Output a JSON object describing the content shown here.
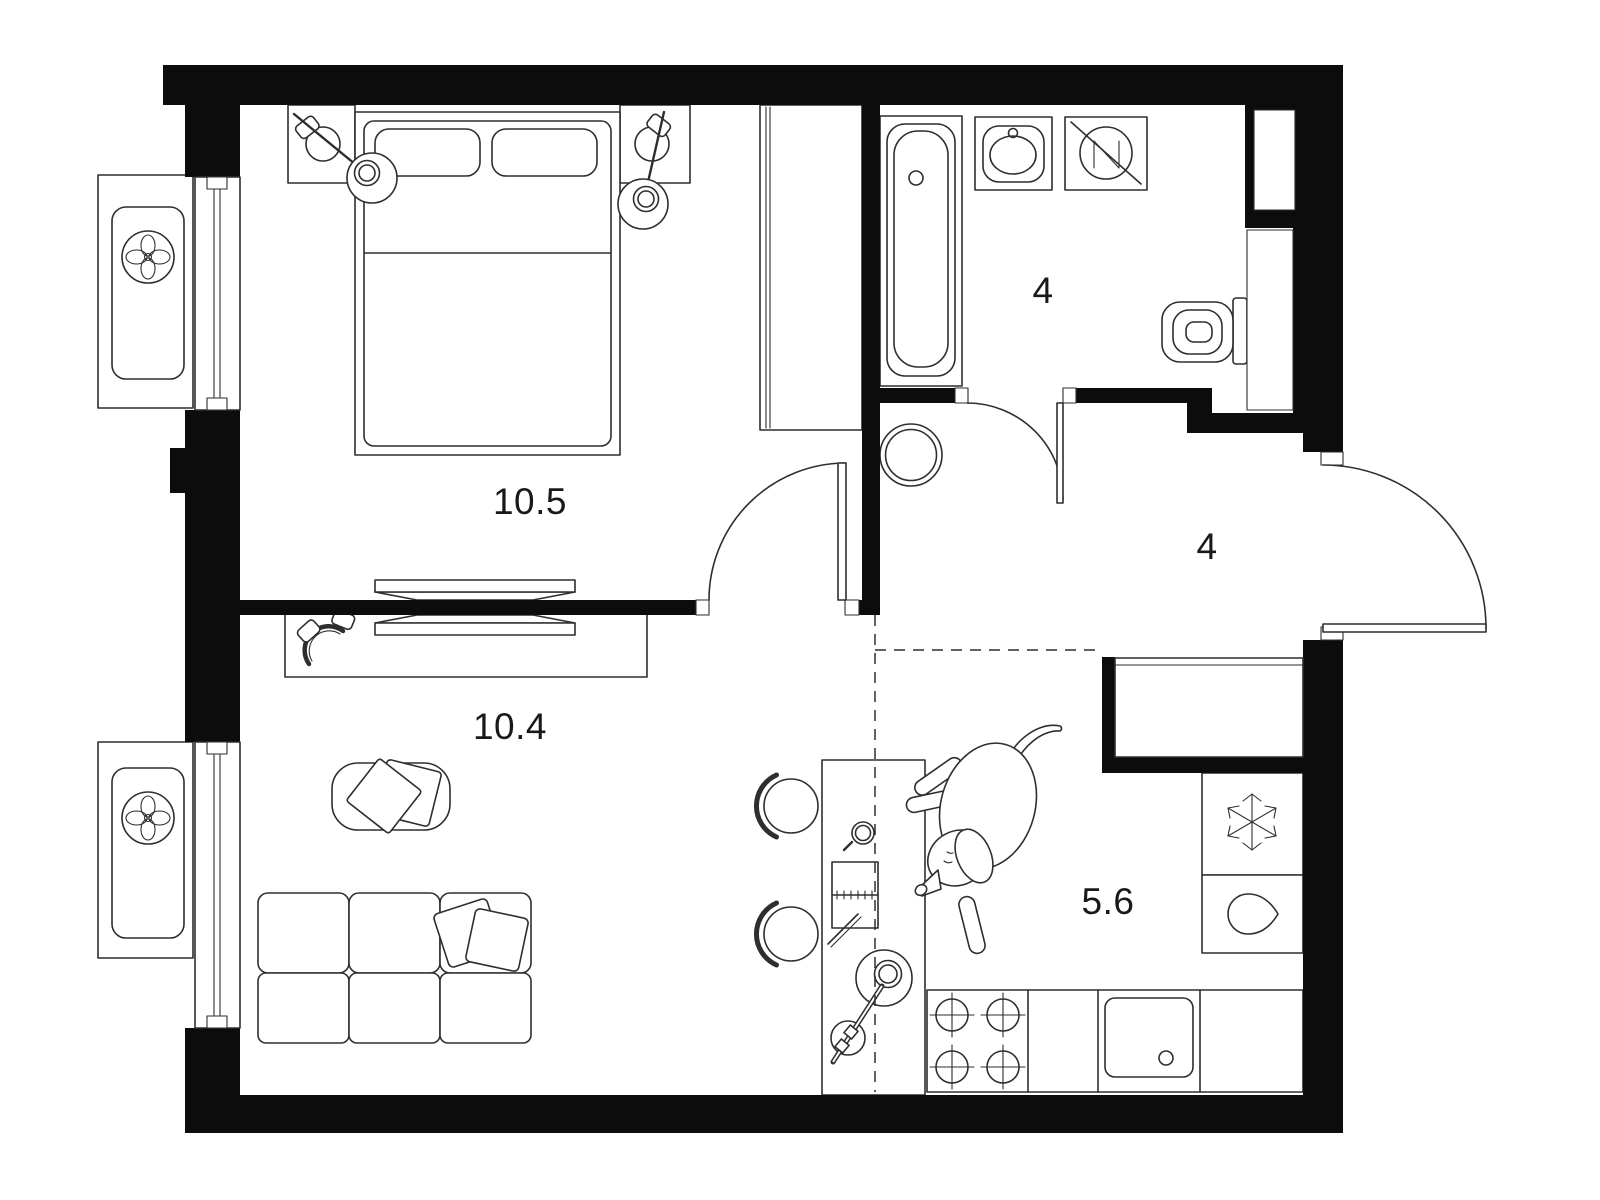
{
  "plan": {
    "title": "Apartment floor plan",
    "rooms": [
      {
        "name": "bedroom",
        "area_label": "10.5"
      },
      {
        "name": "living-room",
        "area_label": "10.4"
      },
      {
        "name": "bathroom",
        "area_label": "4"
      },
      {
        "name": "hallway",
        "area_label": "4"
      },
      {
        "name": "kitchen",
        "area_label": "5.6"
      }
    ],
    "colors": {
      "wall": "#0c0c0c",
      "line": "#2e2e2e",
      "background": "#ffffff",
      "label": "#191919"
    },
    "icons": {
      "ac_fan": "ac-fan-icon",
      "fridge_snowflake": "fridge-snowflake-icon",
      "water_drop": "water-drop-icon",
      "washing_machine": "washing-machine-icon"
    }
  }
}
